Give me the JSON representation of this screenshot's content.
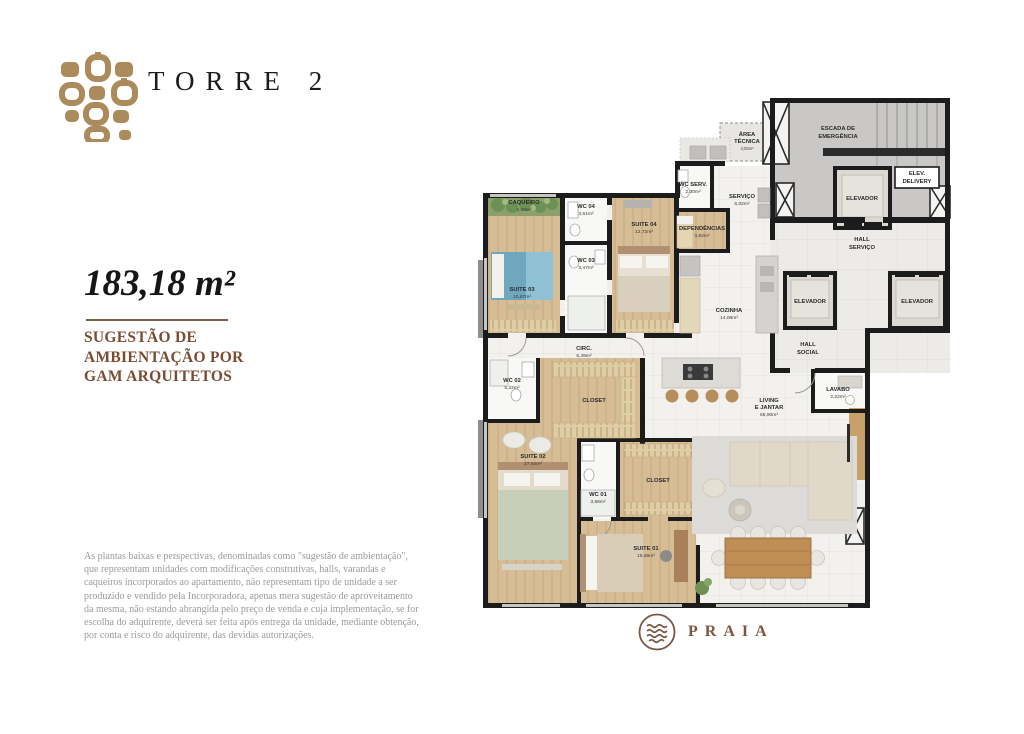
{
  "header": {
    "title": "TORRE 2"
  },
  "unit": {
    "area_label": "183,18 m²",
    "subtitle_lines": [
      "SUGESTÃO DE",
      "AMBIENTAÇÃO POR",
      "GAM ARQUITETOS"
    ]
  },
  "disclaimer": "As plantas baixas e perspectivas, denominadas como \"sugestão de ambientação\", que representam unidades com modificações construtivas, halls, varandas e caqueiros incorporados ao apartamento, não representam tipo de unidade a ser produzido e vendido pela Incorporadora, apenas mera sugestão de aproveitamento da mesma, não estando abrangida pelo preço de venda e cuja implementação, se for escolha do adquirente, deverá ser feita após entrega da unidade, mediante obtenção, por conta e risco do adquirente, das devidas autorizações.",
  "brand": {
    "name": "PRAIA"
  },
  "colors": {
    "brown": "#ab8a5c",
    "text_brown": "#7a4b31",
    "wall": "#1c1c1c"
  },
  "floorplan": {
    "rooms": {
      "caqueiro": {
        "name": "CAQUEIRO",
        "area": "2,60m²"
      },
      "wc04": {
        "name": "WC 04",
        "area": "3,51m²"
      },
      "suite04": {
        "name": "SUITE 04",
        "area": "12,72m²"
      },
      "wc03": {
        "name": "WC 03",
        "area": "3,47m²"
      },
      "suite03": {
        "name": "SUITE 03",
        "area": "10,67m²"
      },
      "wc_serv": {
        "name": "WC SERV.",
        "area": "2,30m²"
      },
      "servico": {
        "name": "SERVIÇO",
        "area": "6,02m²"
      },
      "dependencias": {
        "name": "DEPENDÊNCIAS",
        "area": "3,84m²"
      },
      "area_tecnica": {
        "line1": "ÁREA",
        "line2": "TÉCNICA",
        "area": "4,03m²"
      },
      "escada": {
        "line1": "ESCADA DE",
        "line2": "EMERGÊNCIA"
      },
      "elevador": {
        "name": "ELEVADOR"
      },
      "elev_delivery": {
        "line1": "ELEV.",
        "line2": "DELIVERY"
      },
      "hall_servico": {
        "line1": "HALL",
        "line2": "SERVIÇO"
      },
      "hall_social": {
        "line1": "HALL",
        "line2": "SOCIAL"
      },
      "cozinha": {
        "name": "COZINHA",
        "area": "14,06m²"
      },
      "circ": {
        "name": "CIRC.",
        "area": "6,49m²"
      },
      "wc02": {
        "name": "WC 02",
        "area": "5,22m²"
      },
      "closet": {
        "name": "CLOSET"
      },
      "suite02": {
        "name": "SUITE 02",
        "area": "27,64m²"
      },
      "wc01": {
        "name": "WC 01",
        "area": "3,58m²"
      },
      "suite01": {
        "name": "SUITE 01",
        "area": "16,66m²"
      },
      "living": {
        "line1": "LIVING",
        "line2": "E JANTAR",
        "area": "55,90m²"
      },
      "lavabo": {
        "name": "LAVABO",
        "area": "2,22m²"
      }
    }
  }
}
